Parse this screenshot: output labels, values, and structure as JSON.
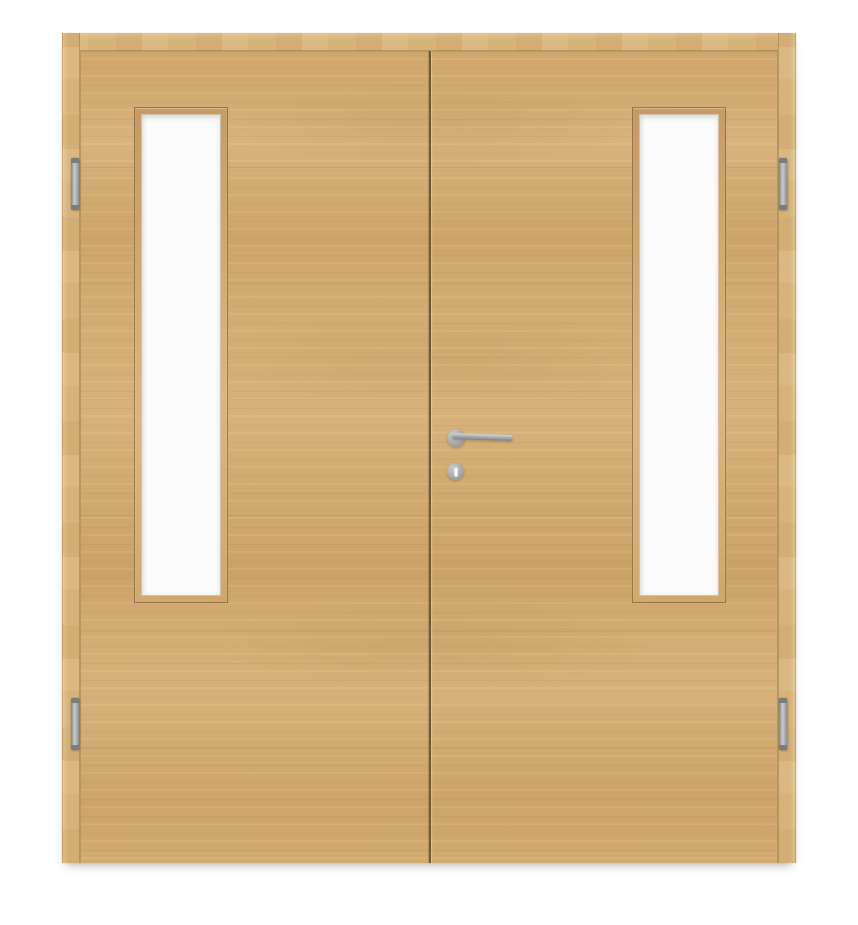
{
  "scene": {
    "type": "product-photo",
    "subject": "Double interior wooden door with surrounding frame, light oak veneer with horizontal grain; each leaf has a narrow vertical glass lite; stainless-steel lever handle with round rosette and keyhole escutcheon on the right leaf; two hinges per leaf",
    "background_color": "#ffffff"
  },
  "palette": {
    "background": "#ffffff",
    "wood_base": "#d3aa71",
    "wood_frame": "#d7b279",
    "wood_light": "#e2c38c",
    "wood_dark": "#bf975c",
    "gap_line": "#6f5937",
    "glazing_bevel": "#c59a60",
    "glass": "#fcfcfd",
    "metal_light": "#c9cbcd",
    "metal_mid": "#a4a7a9",
    "metal_dark": "#797c80"
  },
  "parts": {
    "frame": {
      "label": "door-frame",
      "sides": [
        "head",
        "left-jamb",
        "right-jamb"
      ]
    },
    "leaves": [
      {
        "label": "left-leaf",
        "glazing": "vertical-glass-lite"
      },
      {
        "label": "right-leaf",
        "glazing": "vertical-glass-lite"
      }
    ],
    "hinges": {
      "count": 4,
      "positions": [
        "left-top",
        "left-bottom",
        "right-top",
        "right-bottom"
      ],
      "finish": "stainless"
    },
    "hardware": {
      "handle": "lever-handle-round-rosette",
      "handle_leaf": "right-leaf",
      "keyhole": "round-escutcheon-below-handle",
      "finish": "stainless"
    }
  }
}
